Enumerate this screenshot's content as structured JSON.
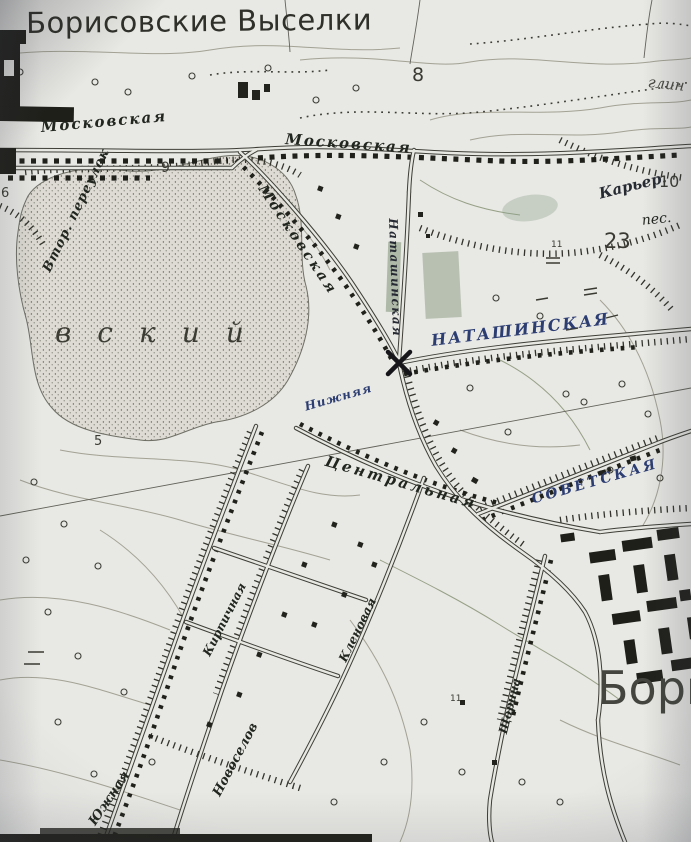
{
  "map": {
    "title": "Борисовские Выселки",
    "large_labels": {
      "area_partial": "вский",
      "town_partial": "Бори"
    },
    "streets": {
      "moskovskaya_left": "Московская",
      "moskovskaya_mid": "Московская",
      "moskovskaya_diag": "Московская",
      "vtor_pereulok": "Втор. переулок",
      "natashinskaya_vertical": "Наташинская",
      "natashinskaya": "НАТАШИНСКАЯ",
      "nizhnyaya": "Нижняя",
      "tsentralnaya": "Центральная",
      "sovetskaya": "СОВЕТСКАЯ",
      "kirpichnaya": "Кирпичная",
      "yuzhnaya": "Южная",
      "novoselov": "Новоселов",
      "klenovaya": "Кленовая",
      "shchorina": "Щорина"
    },
    "annotations": {
      "quarry": "Карьер.",
      "sand": "пес.",
      "clay": "глин",
      "n5": "5",
      "n6": "6",
      "n8": "8",
      "n9": "9",
      "n10": "10",
      "n23": "23",
      "n11a": "11",
      "n11b": "11"
    }
  }
}
